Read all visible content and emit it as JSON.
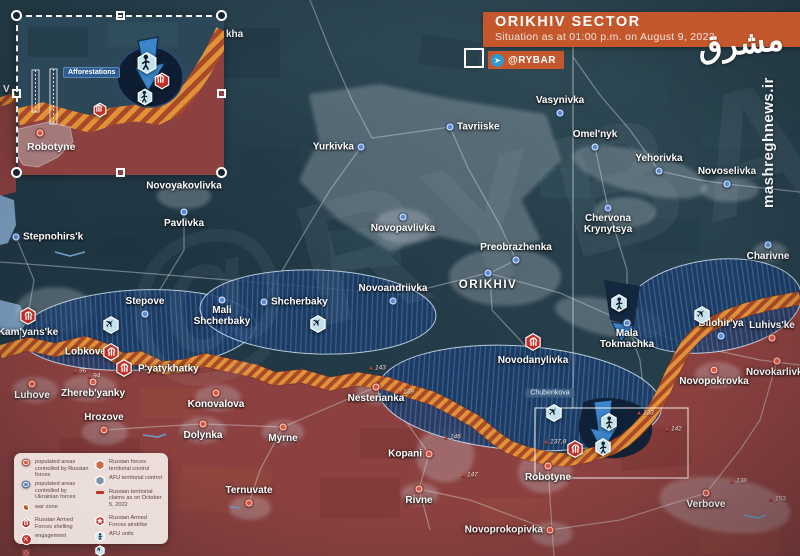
{
  "header": {
    "title": "ORIKHIV SECTOR",
    "subtitle": "Situation as at 01:00 p.m. on August 9, 2023",
    "channel": "@RYBAR",
    "telegram_icon": "telegram-icon",
    "accent_color": "#c4572c"
  },
  "watermarks": {
    "diagonal": "@RYBAR",
    "site_vertical": "mashreghnews.ir",
    "logo_text": "مشرق"
  },
  "inset": {
    "afforestations_label": "Afforestations",
    "town_label": "Robotyne"
  },
  "map": {
    "towns": [
      {
        "n": "Vasynivka",
        "x": 560,
        "y": 113,
        "c": "ua",
        "lp": "a"
      },
      {
        "n": "Tavriiske",
        "x": 450,
        "y": 127,
        "c": "ua",
        "lp": "r"
      },
      {
        "n": "Yurkivka",
        "x": 361,
        "y": 147,
        "c": "ua",
        "lp": "l"
      },
      {
        "n": "Omel'nyk",
        "x": 595,
        "y": 147,
        "c": "ua",
        "lp": "a"
      },
      {
        "n": "Yehorivka",
        "x": 659,
        "y": 171,
        "c": "ua",
        "lp": "a"
      },
      {
        "n": "Novoselivka",
        "x": 727,
        "y": 184,
        "c": "ua",
        "lp": "a"
      },
      {
        "n": "Novoyakovlivka",
        "x": 184,
        "y": 186,
        "c": "ua",
        "lp": "c",
        "d": 0
      },
      {
        "n": "Pavlivka",
        "x": 184,
        "y": 212,
        "c": "ua",
        "lp": "b"
      },
      {
        "n": "Stepnohirs'k",
        "x": 16,
        "y": 237,
        "c": "ua",
        "lp": "r"
      },
      {
        "n": "Novopavlivka",
        "x": 403,
        "y": 217,
        "c": "ua",
        "lp": "b"
      },
      {
        "n": "Preobrazhenka",
        "x": 516,
        "y": 260,
        "c": "ua",
        "lp": "a"
      },
      {
        "n": "Chervona Krynytsya",
        "x": 608,
        "y": 208,
        "c": "ua",
        "lp": "b",
        "nl": 1
      },
      {
        "n": "Charivne",
        "x": 768,
        "y": 245,
        "c": "ua",
        "lp": "b"
      },
      {
        "n": "Stepove",
        "x": 145,
        "y": 314,
        "c": "ua",
        "lp": "a"
      },
      {
        "n": "Mali Shcherbaky",
        "x": 222,
        "y": 300,
        "c": "ua",
        "lp": "b",
        "nl": 1
      },
      {
        "n": "Shcherbaky",
        "x": 264,
        "y": 302,
        "c": "ua",
        "lp": "r"
      },
      {
        "n": "Novoandriivka",
        "x": 393,
        "y": 301,
        "c": "ua",
        "lp": "a"
      },
      {
        "n": "ORIKHIV",
        "x": 488,
        "y": 273,
        "c": "ua",
        "lp": "b",
        "big": 1
      },
      {
        "n": "Novodanylivka",
        "x": 533,
        "y": 349,
        "c": "ua",
        "lp": "b",
        "d": 0
      },
      {
        "n": "Mala Tokmachka",
        "x": 627,
        "y": 323,
        "c": "ua",
        "lp": "b",
        "nl": 1
      },
      {
        "n": "Bilohir'ya",
        "x": 721,
        "y": 336,
        "c": "ua",
        "lp": "a"
      },
      {
        "n": "Kam'yans'ke",
        "x": 28,
        "y": 321,
        "c": "ua",
        "lp": "b",
        "d": 0
      },
      {
        "n": "Lobkove",
        "x": 113,
        "y": 352,
        "c": "ua",
        "lp": "l",
        "d": 0
      },
      {
        "n": "P'yatykhatky",
        "x": 131,
        "y": 369,
        "c": "ua",
        "lp": "r",
        "d": 0
      },
      {
        "n": "Luhove",
        "x": 32,
        "y": 384,
        "c": "ru",
        "lp": "b"
      },
      {
        "n": "Zhereb'yanky",
        "x": 93,
        "y": 382,
        "c": "ru",
        "lp": "b"
      },
      {
        "n": "Konovalova",
        "x": 216,
        "y": 393,
        "c": "ru",
        "lp": "b"
      },
      {
        "n": "Hrozove",
        "x": 104,
        "y": 430,
        "c": "ru",
        "lp": "a"
      },
      {
        "n": "Dolynka",
        "x": 203,
        "y": 424,
        "c": "ru",
        "lp": "b"
      },
      {
        "n": "Myrne",
        "x": 283,
        "y": 427,
        "c": "ru",
        "lp": "b"
      },
      {
        "n": "Nesterianka",
        "x": 376,
        "y": 387,
        "c": "ru",
        "lp": "b"
      },
      {
        "n": "Kopani",
        "x": 429,
        "y": 454,
        "c": "ru",
        "lp": "l"
      },
      {
        "n": "Ternuvate",
        "x": 249,
        "y": 503,
        "c": "ru",
        "lp": "a"
      },
      {
        "n": "Rivne",
        "x": 419,
        "y": 489,
        "c": "ru",
        "lp": "b"
      },
      {
        "n": "Robotyne",
        "x": 548,
        "y": 466,
        "c": "ru",
        "lp": "b"
      },
      {
        "n": "Novoprokopivka",
        "x": 550,
        "y": 530,
        "c": "ru",
        "lp": "l"
      },
      {
        "n": "Verbove",
        "x": 706,
        "y": 493,
        "c": "ru",
        "lp": "b"
      },
      {
        "n": "Luhivs'ke",
        "x": 772,
        "y": 338,
        "c": "ru",
        "lp": "a"
      },
      {
        "n": "Novokarlivka",
        "x": 777,
        "y": 361,
        "c": "ru",
        "lp": "b"
      },
      {
        "n": "Novopokrovka",
        "x": 714,
        "y": 370,
        "c": "ru",
        "lp": "b"
      }
    ],
    "markers": [
      {
        "t": "shelling",
        "x": 28,
        "y": 316
      },
      {
        "t": "shelling",
        "x": 111,
        "y": 352
      },
      {
        "t": "shelling",
        "x": 124,
        "y": 368
      },
      {
        "t": "shelling",
        "x": 533,
        "y": 342
      },
      {
        "t": "shelling",
        "x": 575,
        "y": 449
      },
      {
        "t": "aviation",
        "x": 111,
        "y": 325
      },
      {
        "t": "aviation",
        "x": 318,
        "y": 324
      },
      {
        "t": "aviation",
        "x": 702,
        "y": 315
      },
      {
        "t": "aviation",
        "x": 554,
        "y": 413
      },
      {
        "t": "afu-unit",
        "x": 619,
        "y": 303
      },
      {
        "t": "afu-unit",
        "x": 609,
        "y": 422
      },
      {
        "t": "afu-unit",
        "x": 603,
        "y": 447
      }
    ],
    "elevations": [
      {
        "v": "96",
        "x": 72,
        "y": 371
      },
      {
        "v": "94",
        "x": 86,
        "y": 376
      },
      {
        "v": "143",
        "x": 368,
        "y": 368
      },
      {
        "v": "139",
        "x": 396,
        "y": 392
      },
      {
        "v": "146",
        "x": 443,
        "y": 437
      },
      {
        "v": "147",
        "x": 460,
        "y": 475
      },
      {
        "v": "137,8",
        "x": 543,
        "y": 442
      },
      {
        "v": "133",
        "x": 636,
        "y": 413
      },
      {
        "v": "142",
        "x": 664,
        "y": 429
      },
      {
        "v": "138",
        "x": 729,
        "y": 481
      },
      {
        "v": "153",
        "x": 768,
        "y": 499
      }
    ],
    "area_labels": [
      {
        "n": "Chubenkova",
        "x": 550,
        "y": 393
      }
    ],
    "fragments": [
      {
        "t": "kha",
        "x": 226,
        "y": 29
      },
      {
        "t": "V",
        "x": 3,
        "y": 84
      }
    ],
    "inset_markers": [
      {
        "t": "afu-unit",
        "x": 129,
        "y": 46,
        "s": 22
      },
      {
        "t": "afu-unit",
        "x": 127,
        "y": 80,
        "s": 17
      },
      {
        "t": "shelling",
        "x": 144,
        "y": 64,
        "s": 17
      },
      {
        "t": "shelling",
        "x": 82,
        "y": 93,
        "s": 15
      },
      {
        "t": "dot-ru",
        "x": 22,
        "y": 116,
        "s": 8
      }
    ]
  },
  "legend": {
    "columns": [
      [
        {
          "icon": "dot-ru",
          "label": "populated areas controlled by Russian forces"
        },
        {
          "icon": "dot-ua",
          "label": "populated areas controlled by Ukrainian forces"
        },
        {
          "icon": "war-zone",
          "label": "war zone"
        },
        {
          "icon": "shelling",
          "label": "Russian Armed Forces shelling",
          "gap": 1
        },
        {
          "icon": "engagement",
          "label": "engagement"
        },
        {
          "icon": "disrupted",
          "label": "disrupted offensive"
        }
      ],
      [
        {
          "icon": "hex-ru",
          "label": "Russian forces territorial control"
        },
        {
          "icon": "hex-ua",
          "label": "AFU territorial control"
        },
        {
          "icon": "claim-line",
          "label": "Russian territorial claims as on October 5, 2022"
        },
        {
          "icon": "airstrike",
          "label": "Russian Armed Forces airstrike",
          "gap": 1
        },
        {
          "icon": "afu-unit",
          "label": "AFU units"
        },
        {
          "icon": "aviation",
          "label": "AFU's tactical aviation"
        }
      ]
    ]
  },
  "colors": {
    "header_accent": "#c4572c",
    "russian_area": "#8c4140",
    "ukrainian_base": "#273f4d",
    "afu_control": "#1e3c66",
    "war_zone_stripe_light": "#df9238",
    "war_zone_stripe_dark": "#a8492a",
    "icon_red": "#c23128",
    "icon_pale_blue": "#c3e2ef"
  }
}
